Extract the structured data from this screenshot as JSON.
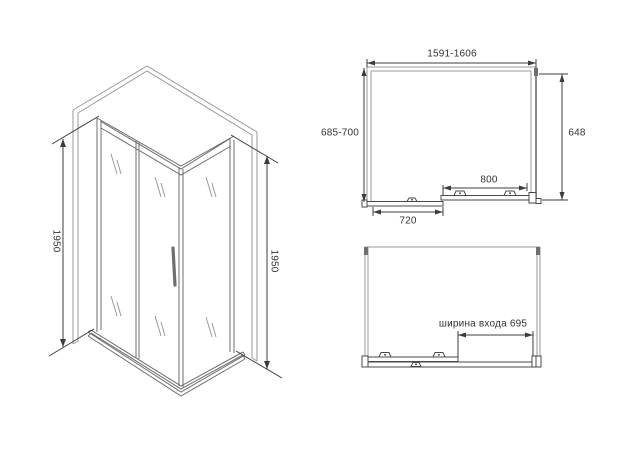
{
  "views": {
    "isometric": {
      "height_left": "1950",
      "height_right": "1950"
    },
    "plan_closed": {
      "width": "1591-1606",
      "depth": "685-700",
      "side_panel": "648",
      "door": "800",
      "fixed_panel": "720"
    },
    "plan_open": {
      "entrance_width": "ширина входа 695"
    }
  },
  "colors": {
    "line_light": "#9a9a9a",
    "line_mid": "#6e6e6e",
    "line_dark": "#4a4a4a",
    "dim": "#3c3c3c",
    "text": "#333333",
    "background": "#ffffff"
  }
}
